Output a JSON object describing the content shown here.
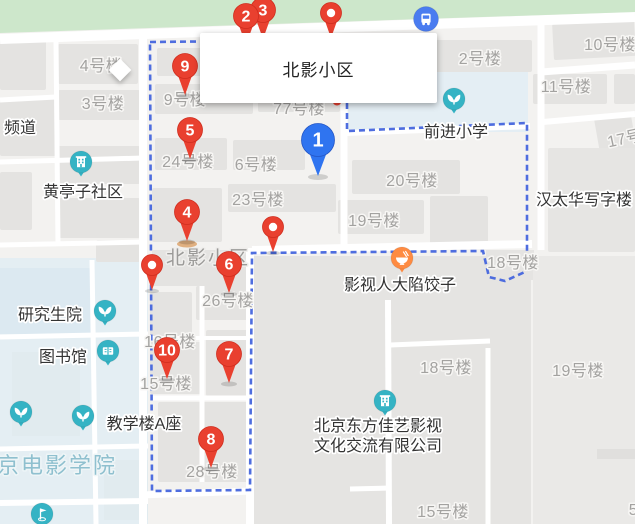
{
  "info_box": {
    "title": "北影小区"
  },
  "area_labels": [
    {
      "name": "estate-area-label",
      "text": "北影小区",
      "x": 208,
      "y": 264,
      "kind": "estate"
    },
    {
      "name": "campus-area-label",
      "text": "京电影学院",
      "x": 57,
      "y": 473,
      "kind": "campus"
    }
  ],
  "building_labels": [
    {
      "text": "4号楼",
      "x": 101,
      "y": 71
    },
    {
      "text": "3号楼",
      "x": 103,
      "y": 109
    },
    {
      "text": "9号楼",
      "x": 185,
      "y": 105
    },
    {
      "text": "77号楼",
      "x": 299,
      "y": 114
    },
    {
      "text": "2号楼",
      "x": 480,
      "y": 64
    },
    {
      "text": "10号楼",
      "x": 610,
      "y": 50
    },
    {
      "text": "11号楼",
      "x": 566,
      "y": 92
    },
    {
      "text": "17号楼",
      "x": 634,
      "y": 142,
      "angle": -12
    },
    {
      "text": "24号楼",
      "x": 188,
      "y": 167
    },
    {
      "text": "6号楼",
      "x": 256,
      "y": 170
    },
    {
      "text": "23号楼",
      "x": 258,
      "y": 205
    },
    {
      "text": "20号楼",
      "x": 412,
      "y": 186
    },
    {
      "text": "19号楼",
      "x": 374,
      "y": 226
    },
    {
      "text": "18号楼",
      "x": 513,
      "y": 268
    },
    {
      "text": "26号楼",
      "x": 228,
      "y": 306
    },
    {
      "text": "16号楼",
      "x": 170,
      "y": 347
    },
    {
      "text": "15号楼",
      "x": 166,
      "y": 389
    },
    {
      "text": "18号楼",
      "x": 446,
      "y": 373
    },
    {
      "text": "19号楼",
      "x": 578,
      "y": 376
    },
    {
      "text": "28号楼",
      "x": 212,
      "y": 477
    },
    {
      "text": "15号楼",
      "x": 443,
      "y": 517
    },
    {
      "text": "5号楼",
      "x": 650,
      "y": 515
    }
  ],
  "pois": [
    {
      "name": "pindao-label",
      "text": "频道",
      "tx": 20,
      "ty": 133
    },
    {
      "name": "huangtingzi-community",
      "text": "黄亭子社区",
      "tx": 83,
      "ty": 197,
      "icon": {
        "glyph": "building",
        "x": 81,
        "y": 162,
        "color": "#35b3c4"
      }
    },
    {
      "name": "qianjin-primary-school",
      "text": "前进小学",
      "tx": 456,
      "ty": 137,
      "icon": {
        "glyph": "sprout",
        "x": 454,
        "y": 99,
        "color": "#35b3c4"
      }
    },
    {
      "name": "graduate-school",
      "text": "研究生院",
      "tx": 50,
      "ty": 320,
      "icon": {
        "glyph": "sprout",
        "x": 105,
        "y": 311,
        "color": "#35b3c4"
      }
    },
    {
      "name": "library",
      "text": "图书馆",
      "tx": 63,
      "ty": 362,
      "icon": {
        "glyph": "book",
        "x": 108,
        "y": 351,
        "color": "#35b3c4"
      }
    },
    {
      "name": "teaching-building-a",
      "text": "教学楼A座",
      "tx": 144,
      "ty": 429,
      "icon": {
        "glyph": "sprout",
        "x": 83,
        "y": 416,
        "color": "#35b3c4"
      }
    },
    {
      "name": "film-dumpling-restaurant",
      "text": "影视人大陷饺子",
      "tx": 400,
      "ty": 290,
      "icon": {
        "glyph": "bowl",
        "x": 402,
        "y": 258,
        "color": "#fe8b42"
      }
    },
    {
      "name": "hantaihua-office",
      "text": "汉太华写字楼",
      "tx": 584,
      "ty": 205
    },
    {
      "name": "dongfang-jiayi-company",
      "lines": [
        "北京东方佳艺影视",
        "文化交流有限公司"
      ],
      "tx": 378,
      "ty": 431,
      "line_height": 20,
      "icon": {
        "glyph": "building",
        "x": 385,
        "y": 401,
        "color": "#35b3c4"
      }
    }
  ],
  "solo_icons": [
    {
      "name": "greenery-icon",
      "glyph": "sprout",
      "x": 21,
      "y": 412,
      "color": "#35b3c4"
    },
    {
      "name": "playground-icon",
      "glyph": "flag",
      "x": 42,
      "y": 514,
      "color": "#35b3c4"
    },
    {
      "name": "bus-stop-icon",
      "glyph": "bus",
      "x": 426,
      "y": 19,
      "color": "#4a7cf0",
      "no_tail": true
    },
    {
      "name": "hidden-poi-icon",
      "glyph": "dot",
      "x": 337,
      "y": 101,
      "color": "#e9402f",
      "r": 4.5
    }
  ],
  "markers": [
    {
      "type": "number",
      "color": "red",
      "label": "3",
      "x": 263,
      "y": 10
    },
    {
      "type": "number",
      "color": "red",
      "label": "2",
      "x": 246,
      "y": 16
    },
    {
      "type": "dot",
      "label": "",
      "x": 331,
      "y": 13
    },
    {
      "type": "number",
      "color": "red",
      "label": "9",
      "x": 185,
      "y": 66
    },
    {
      "type": "number",
      "color": "red",
      "label": "5",
      "x": 190,
      "y": 130
    },
    {
      "type": "number",
      "color": "blue",
      "label": "1",
      "x": 318,
      "y": 140
    },
    {
      "type": "number",
      "color": "red",
      "label": "4",
      "x": 187,
      "y": 212
    },
    {
      "type": "dot",
      "label": "",
      "x": 273,
      "y": 227
    },
    {
      "type": "number",
      "color": "red",
      "label": "6",
      "x": 229,
      "y": 264
    },
    {
      "type": "dot",
      "label": "",
      "x": 152,
      "y": 265
    },
    {
      "type": "number",
      "color": "red",
      "label": "10",
      "x": 167,
      "y": 350
    },
    {
      "type": "number",
      "color": "red",
      "label": "7",
      "x": 229,
      "y": 354
    },
    {
      "type": "number",
      "color": "red",
      "label": "8",
      "x": 211,
      "y": 439
    }
  ],
  "ground_mark": {
    "x": 187,
    "y": 244
  },
  "colors": {
    "marker_red": "#e9402f",
    "marker_red_edge": "#cf2d1e",
    "marker_blue": "#2f74f0",
    "marker_blue_edge": "#2456c6",
    "boundary_blue": "#4565dd",
    "poi_teal": "#35b3c4",
    "poi_orange": "#fe8b42",
    "green_band": "#cde7cb",
    "campus_tint": "#e4eef3"
  }
}
